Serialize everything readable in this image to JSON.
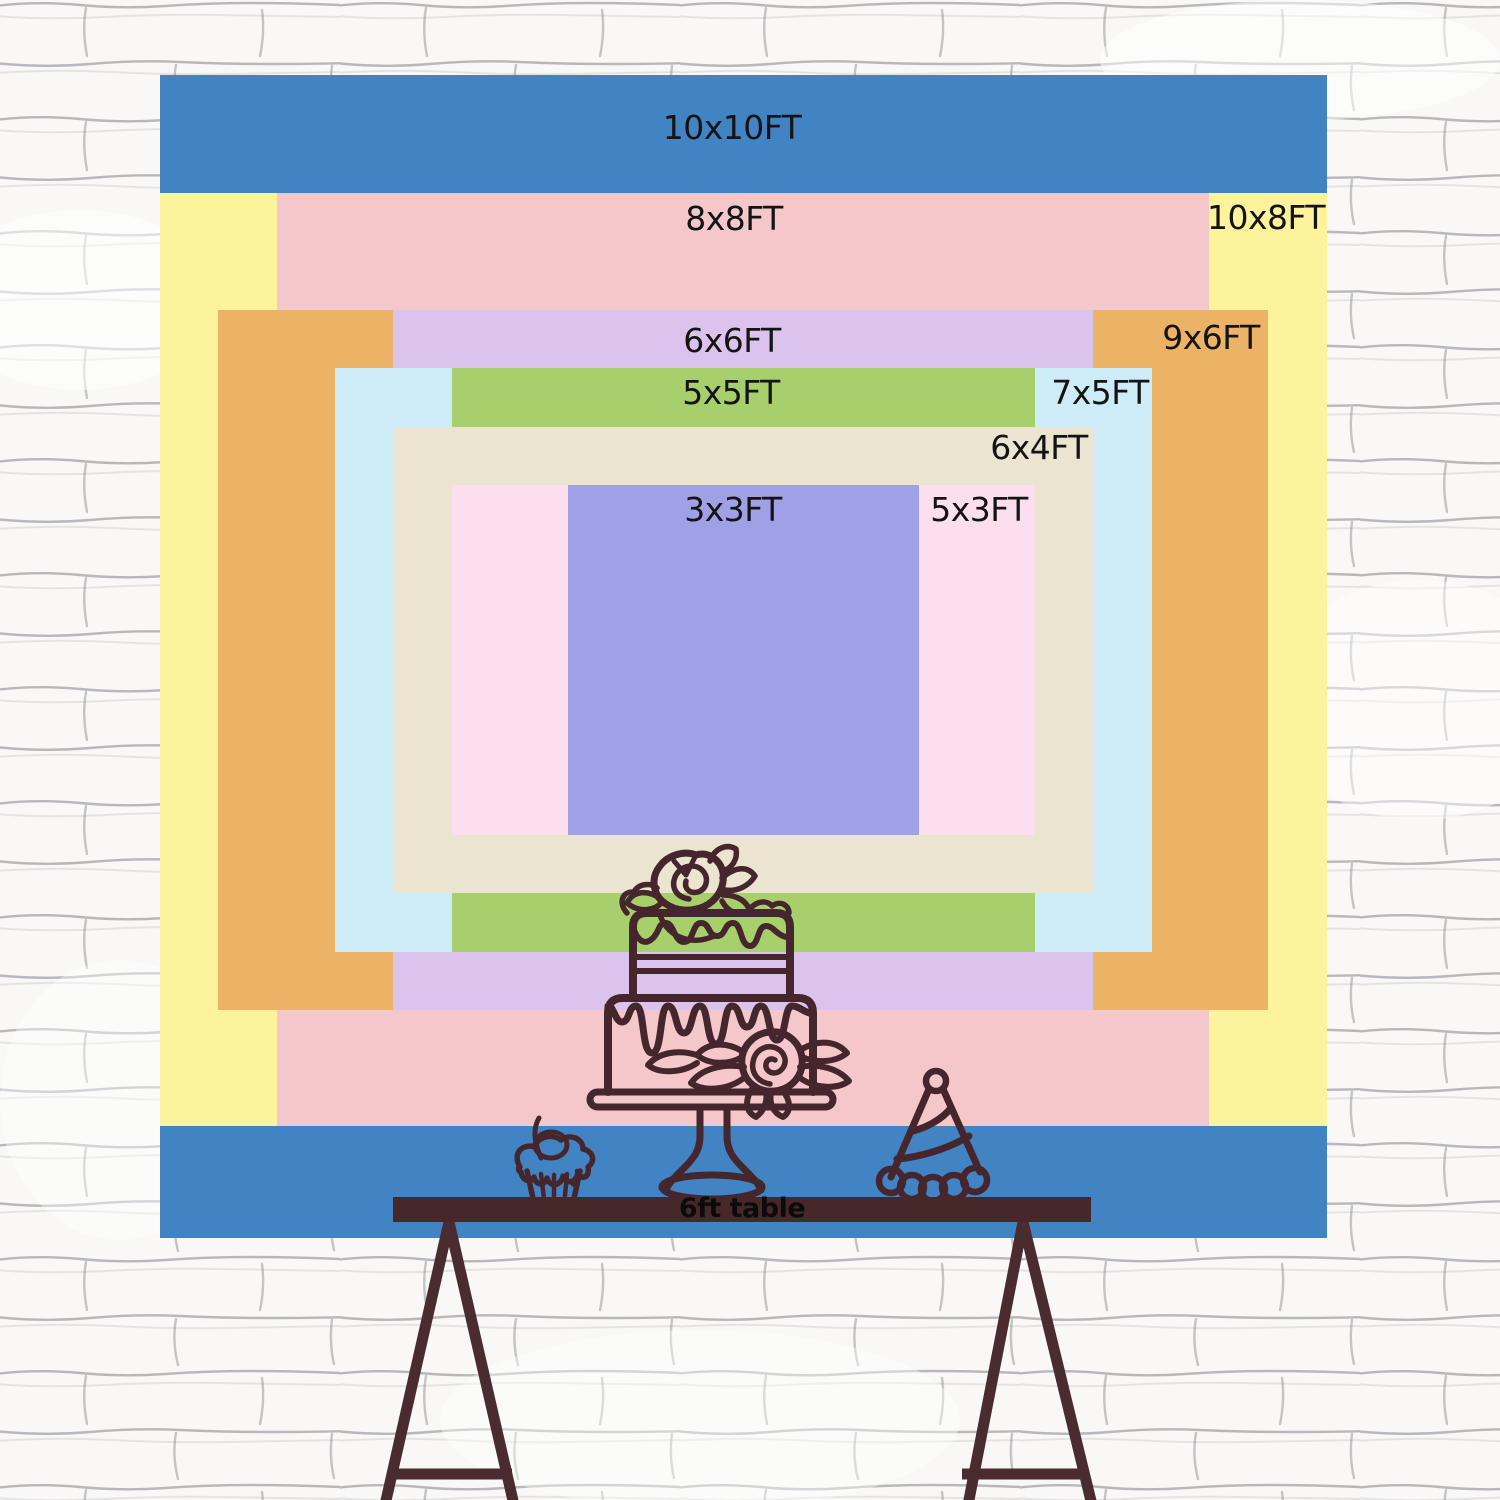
{
  "backdrop": {
    "label_color": "#141414",
    "layers": [
      {
        "id": "10x10ft",
        "label": "10x10FT",
        "color": "#4283c4"
      },
      {
        "id": "10x8ft",
        "label": "10x8FT",
        "color": "#fcf39c"
      },
      {
        "id": "8x8ft",
        "label": "8x8FT",
        "color": "#f4c7ca"
      },
      {
        "id": "9x6ft",
        "label": "9x6FT",
        "color": "#ecb366"
      },
      {
        "id": "6x6ft",
        "label": "6x6FT",
        "color": "#dcc3ee"
      },
      {
        "id": "7x5ft",
        "label": "7x5FT",
        "color": "#cdecf8"
      },
      {
        "id": "5x5ft",
        "label": "5x5FT",
        "color": "#a7d06d"
      },
      {
        "id": "6x4ft",
        "label": "6x4FT",
        "color": "#eae4d1"
      },
      {
        "id": "5x3ft",
        "label": "5x3FT",
        "color": "#fcdfee"
      },
      {
        "id": "3x3ft",
        "label": "3x3FT",
        "color": "#9fa0e6"
      }
    ]
  },
  "table": {
    "label": "6ft table",
    "color": "#46282a",
    "leg_color": "#4a2c30"
  },
  "artwork": {
    "line_color": "#45262c",
    "items": [
      "birthday-cake-icon",
      "cupcake-icon",
      "party-hat-icon"
    ]
  },
  "wall": {
    "background": "#f9f8f6",
    "line_color": "#83838c"
  }
}
